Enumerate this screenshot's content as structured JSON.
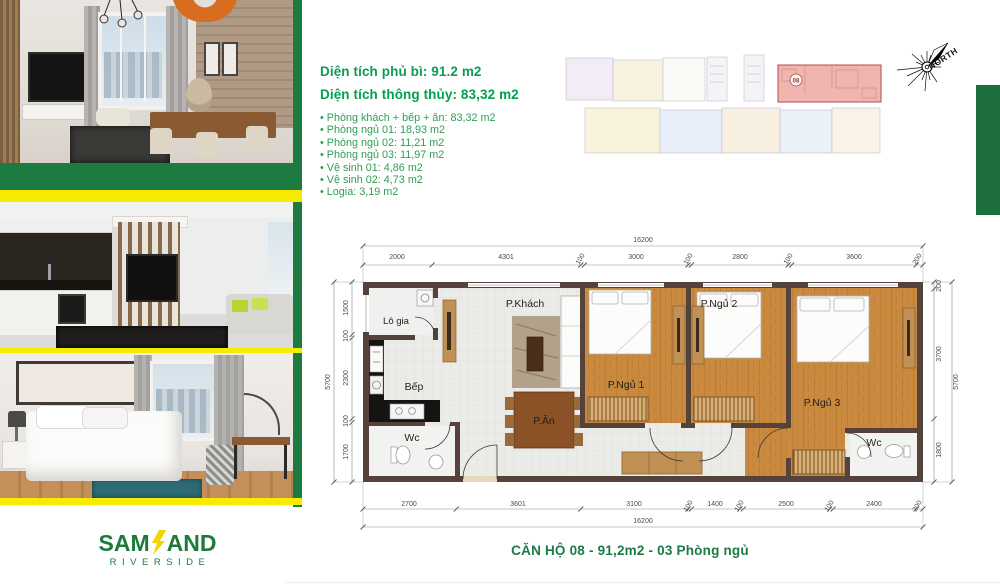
{
  "brand": {
    "logo_sam": "SAM",
    "logo_and": "AND",
    "logo_sub": "RIVERSIDE"
  },
  "specs": {
    "gross_area_label": "Diện tích phủ bì: 91.2 m2",
    "net_area_label": "Diện tích thông thủy: 83,32 m2",
    "rooms": [
      "Phòng khách + bếp + ăn: 83,32 m2",
      "Phòng ngủ 01: 18,93 m2",
      "Phòng ngủ 02: 11,21 m2",
      "Phòng ngủ 03: 11,97 m2",
      "Vệ sinh 01: 4,86 m2",
      "Vệ sinh 02: 4,73 m2",
      "Logia: 3,19 m2"
    ]
  },
  "overview": {
    "highlight_unit": "08"
  },
  "compass": {
    "label": "NORTH"
  },
  "floorplan": {
    "room_labels": {
      "living": "P.Khách",
      "kitchen": "Bếp",
      "dining": "P.Ăn",
      "logia": "Lô gia",
      "wc1": "Wc",
      "wc2": "Wc",
      "bed1": "P.Ngủ 1",
      "bed2": "P.Ngủ 2",
      "bed3": "P.Ngủ 3"
    },
    "dims": {
      "top_total": "16200",
      "top": [
        "2000",
        "4301",
        "100",
        "3000",
        "100",
        "2800",
        "100",
        "3600",
        "200"
      ],
      "bottom": [
        "2700",
        "3601",
        "3100",
        "100",
        "1400",
        "100",
        "2500",
        "100",
        "2400",
        "200"
      ],
      "bottom_total": "16200",
      "left": [
        "1500",
        "100",
        "2300",
        "100",
        "1700"
      ],
      "left_total": "5700",
      "right": [
        "200",
        "3700",
        "1800"
      ],
      "right_total": "5700"
    }
  },
  "caption": {
    "text": "CĂN HỘ 08 - 91,2m2 - 03 Phòng ngủ"
  },
  "colors": {
    "brand_green": "#1d7a40",
    "accent_yellow": "#f7ec00",
    "net_area_green": "#00a14f",
    "highlight_pink": "#efb5ae",
    "wall_brown": "#55423a",
    "wood_floor": "#c9893f"
  }
}
